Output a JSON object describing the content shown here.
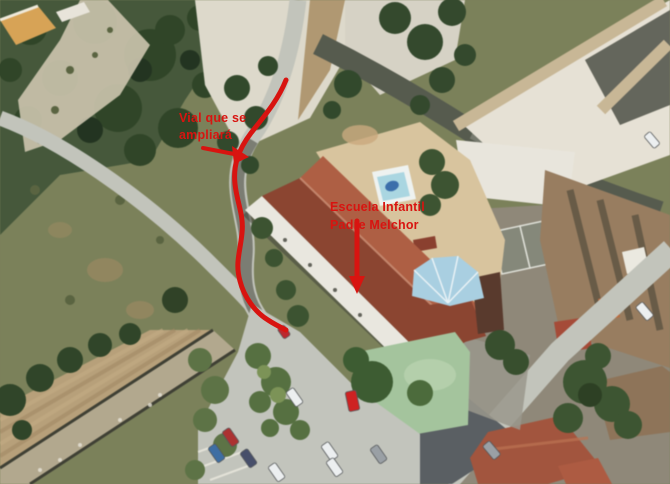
{
  "annotations": {
    "color": "#d81410",
    "road_widening": {
      "line1": "Vial que se",
      "line2": "ampliará"
    },
    "school": {
      "line1": "Escuela Infantil",
      "line2": "Padre Melchor"
    }
  },
  "scene": {
    "colors": {
      "scrub": "#7b8159",
      "vegetation": "#2f4527",
      "vegetation_light": "#45583a",
      "sand": "#ddd9ca",
      "dirt": "#a98c60",
      "dirt_path": "#cdc5ae",
      "road": "#c2c4bb",
      "road_dark": "#565b4e",
      "field": "#b8a078",
      "field_lower": "#b2a88d",
      "hedge": "#2f4528",
      "parking": "#c2c4bc",
      "school_roof_light": "#b15e42",
      "school_roof_dark": "#8d4430",
      "facade": "#e9e7df",
      "patio": "#d9c49c",
      "pool_deck": "#eef2f0",
      "pool_water": "#a9d6e2",
      "pool_figure": "#3a6fae",
      "fan_roof_blue": "#a8cfe2",
      "playground": "#a3c49c",
      "urban_base": "#8f8878",
      "urban_white": "#e6e1d4",
      "parapet": "#c9b795",
      "roof_brown": "#997d5f",
      "roof_red": "#a5543c",
      "roof_orange": "#c06a3a",
      "slate_block": "#5a5f63",
      "car_red": "#d42020",
      "car_blue": "#3c6ea5",
      "car_dark": "#474f6b",
      "car_white": "#eceff0",
      "car_gray": "#9aa0a5"
    }
  }
}
